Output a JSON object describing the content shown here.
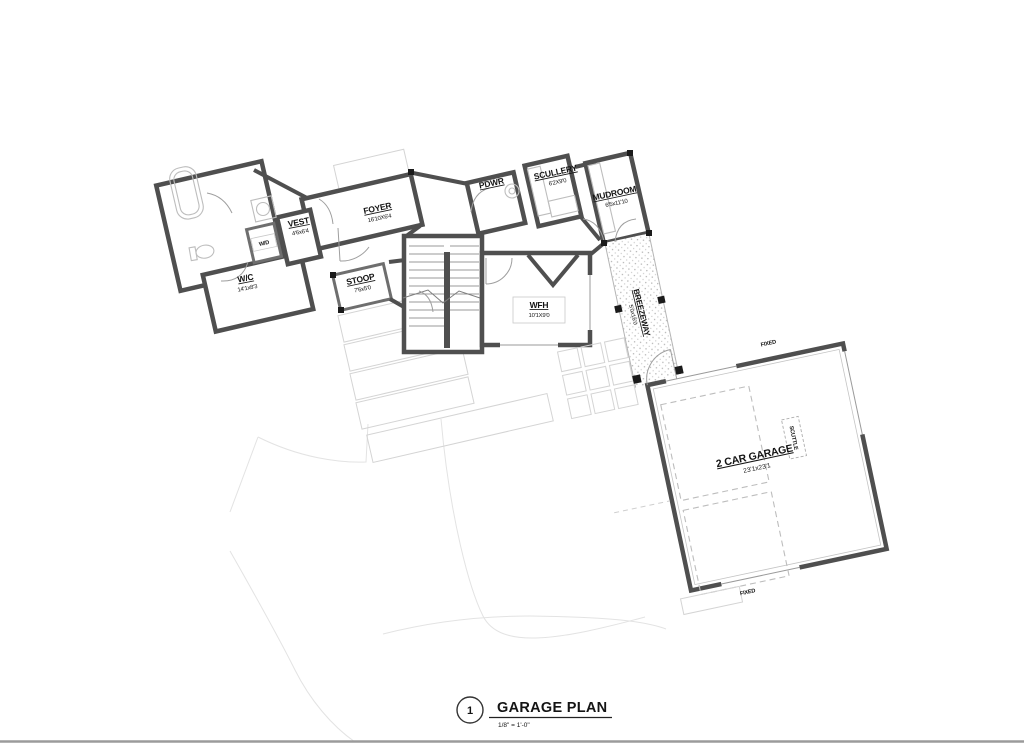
{
  "sheet": {
    "width": 1024,
    "height": 745
  },
  "title_block": {
    "number": "1",
    "title": "GARAGE PLAN",
    "scale": "1/8\" = 1'-0\""
  },
  "rooms": {
    "wc": {
      "name": "W/C",
      "dims": "14'1x8'3"
    },
    "vest": {
      "name": "VEST",
      "dims": "4'6x6'4"
    },
    "foyer": {
      "name": "FOYER",
      "dims": "16'10X6'4"
    },
    "stoop": {
      "name": "STOOP",
      "dims": "7'6x5'0"
    },
    "wd": {
      "name": "W/D"
    },
    "wfh": {
      "name": "WFH",
      "dims": "10'1X9'0"
    },
    "pdwr": {
      "name": "PDWR"
    },
    "scullery": {
      "name": "SCULLERY",
      "dims": "6'2X9'0"
    },
    "mudroom": {
      "name": "MUDROOM",
      "dims": "6'5x11'10"
    },
    "breezeway": {
      "name": "BREEZEWAY",
      "dims": "5'0x16'0"
    },
    "garage": {
      "name": "2 CAR GARAGE",
      "dims": "23'1x23'1"
    },
    "scuttle": {
      "name": "SCUTTLE"
    }
  },
  "annotations": {
    "fixed_top": "FIXED",
    "fixed_bottom": "FIXED"
  },
  "colors": {
    "wall": "#4f4f4f",
    "fixture": "#c0c0c0",
    "site_line": "#e3e3e3",
    "dash": "#bdbdbd",
    "text": "#141414"
  }
}
